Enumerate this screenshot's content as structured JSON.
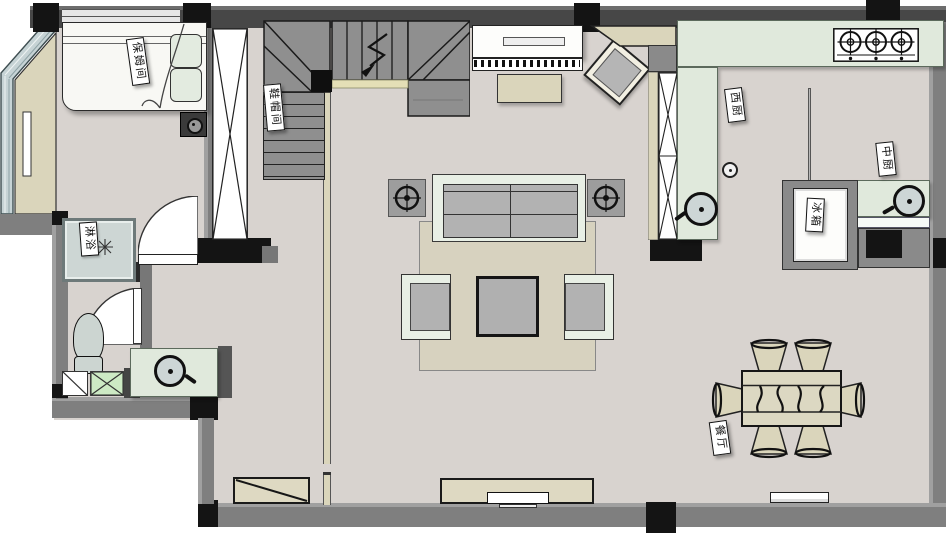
{
  "plan": {
    "labels": {
      "nanny_room": "保姆间",
      "cloakroom": "鞋帽间",
      "shower": "淋浴",
      "west_kitchen": "西厨",
      "chinese_kitchen": "中厨",
      "fridge": "冰箱",
      "dining_room": "餐厅"
    },
    "colors": {
      "floor": "#d8d3cf",
      "wall_dark": "#474747",
      "wall_gray": "#7f7f7f",
      "wall_black": "#141414",
      "counter_green": "#e0e9dc",
      "wood_beige": "#dad5bb",
      "glass_blue": "#c6d3d5",
      "stair_gray": "#8f8f8f",
      "furniture_gray": "#b2b2b2",
      "rug_beige": "#d7d2bf",
      "cabinet_cream": "#ded9c2",
      "fixture_white": "#fdfdfb"
    },
    "icons": {
      "stove_burner": "circled-crosshair",
      "sink": "circle-with-faucet-tick",
      "speaker_crosshair": "circled-crosshair",
      "stair_direction": "zigzag-arrow",
      "shower_head": "sprinkle-asterisk"
    }
  }
}
